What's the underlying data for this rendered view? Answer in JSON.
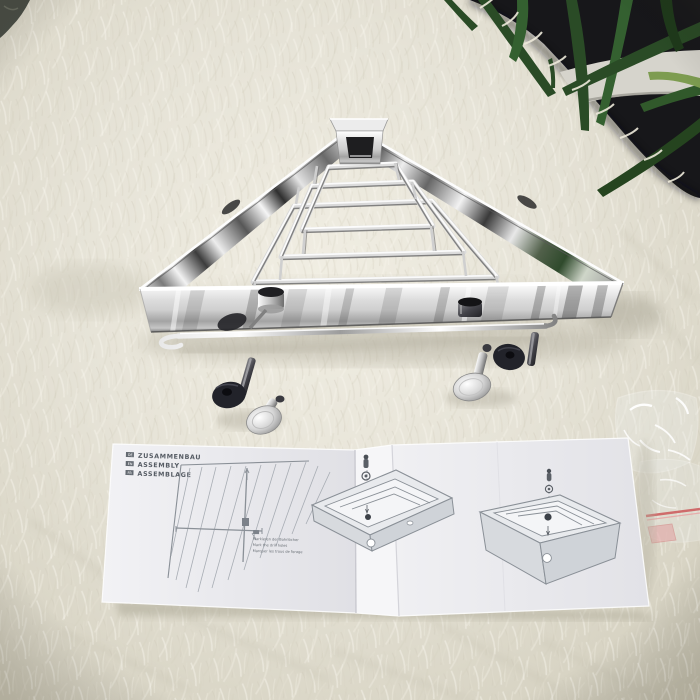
{
  "scene": {
    "description": "Product photograph: polished chrome triangular corner shower basket with towel rail on a white shag rug, mounting hardware sets, a folded tri-lingual assembly instruction leaflet, a clear plastic zip bag, and a potted palm plant against a dark backdrop in the top-right corner.",
    "objects": [
      "corner shower basket",
      "mounting hardware",
      "instruction leaflet",
      "plastic bag",
      "palm plant",
      "shag rug"
    ]
  },
  "leaflet": {
    "header": [
      {
        "tag": "DE",
        "text": "ZUSAMMENBAU"
      },
      {
        "tag": "EN",
        "text": "ASSEMBLY"
      },
      {
        "tag": "FR",
        "text": "ASSEMBLAGE"
      }
    ],
    "caption_lines": [
      "Markieren der Bohrlöcher",
      "Mark the drill holes",
      "Marquer les trous de forage"
    ]
  },
  "colors": {
    "rug": "#e6e3d7",
    "backdrop": "#17171a",
    "leaf_green": "#2a4b26",
    "chrome_highlight": "#ffffff",
    "chrome_shadow": "#3f3f3f",
    "paper": "#ececef",
    "diagram_ink": "#6a7076",
    "bag_seal_red": "#cf6b6b"
  }
}
